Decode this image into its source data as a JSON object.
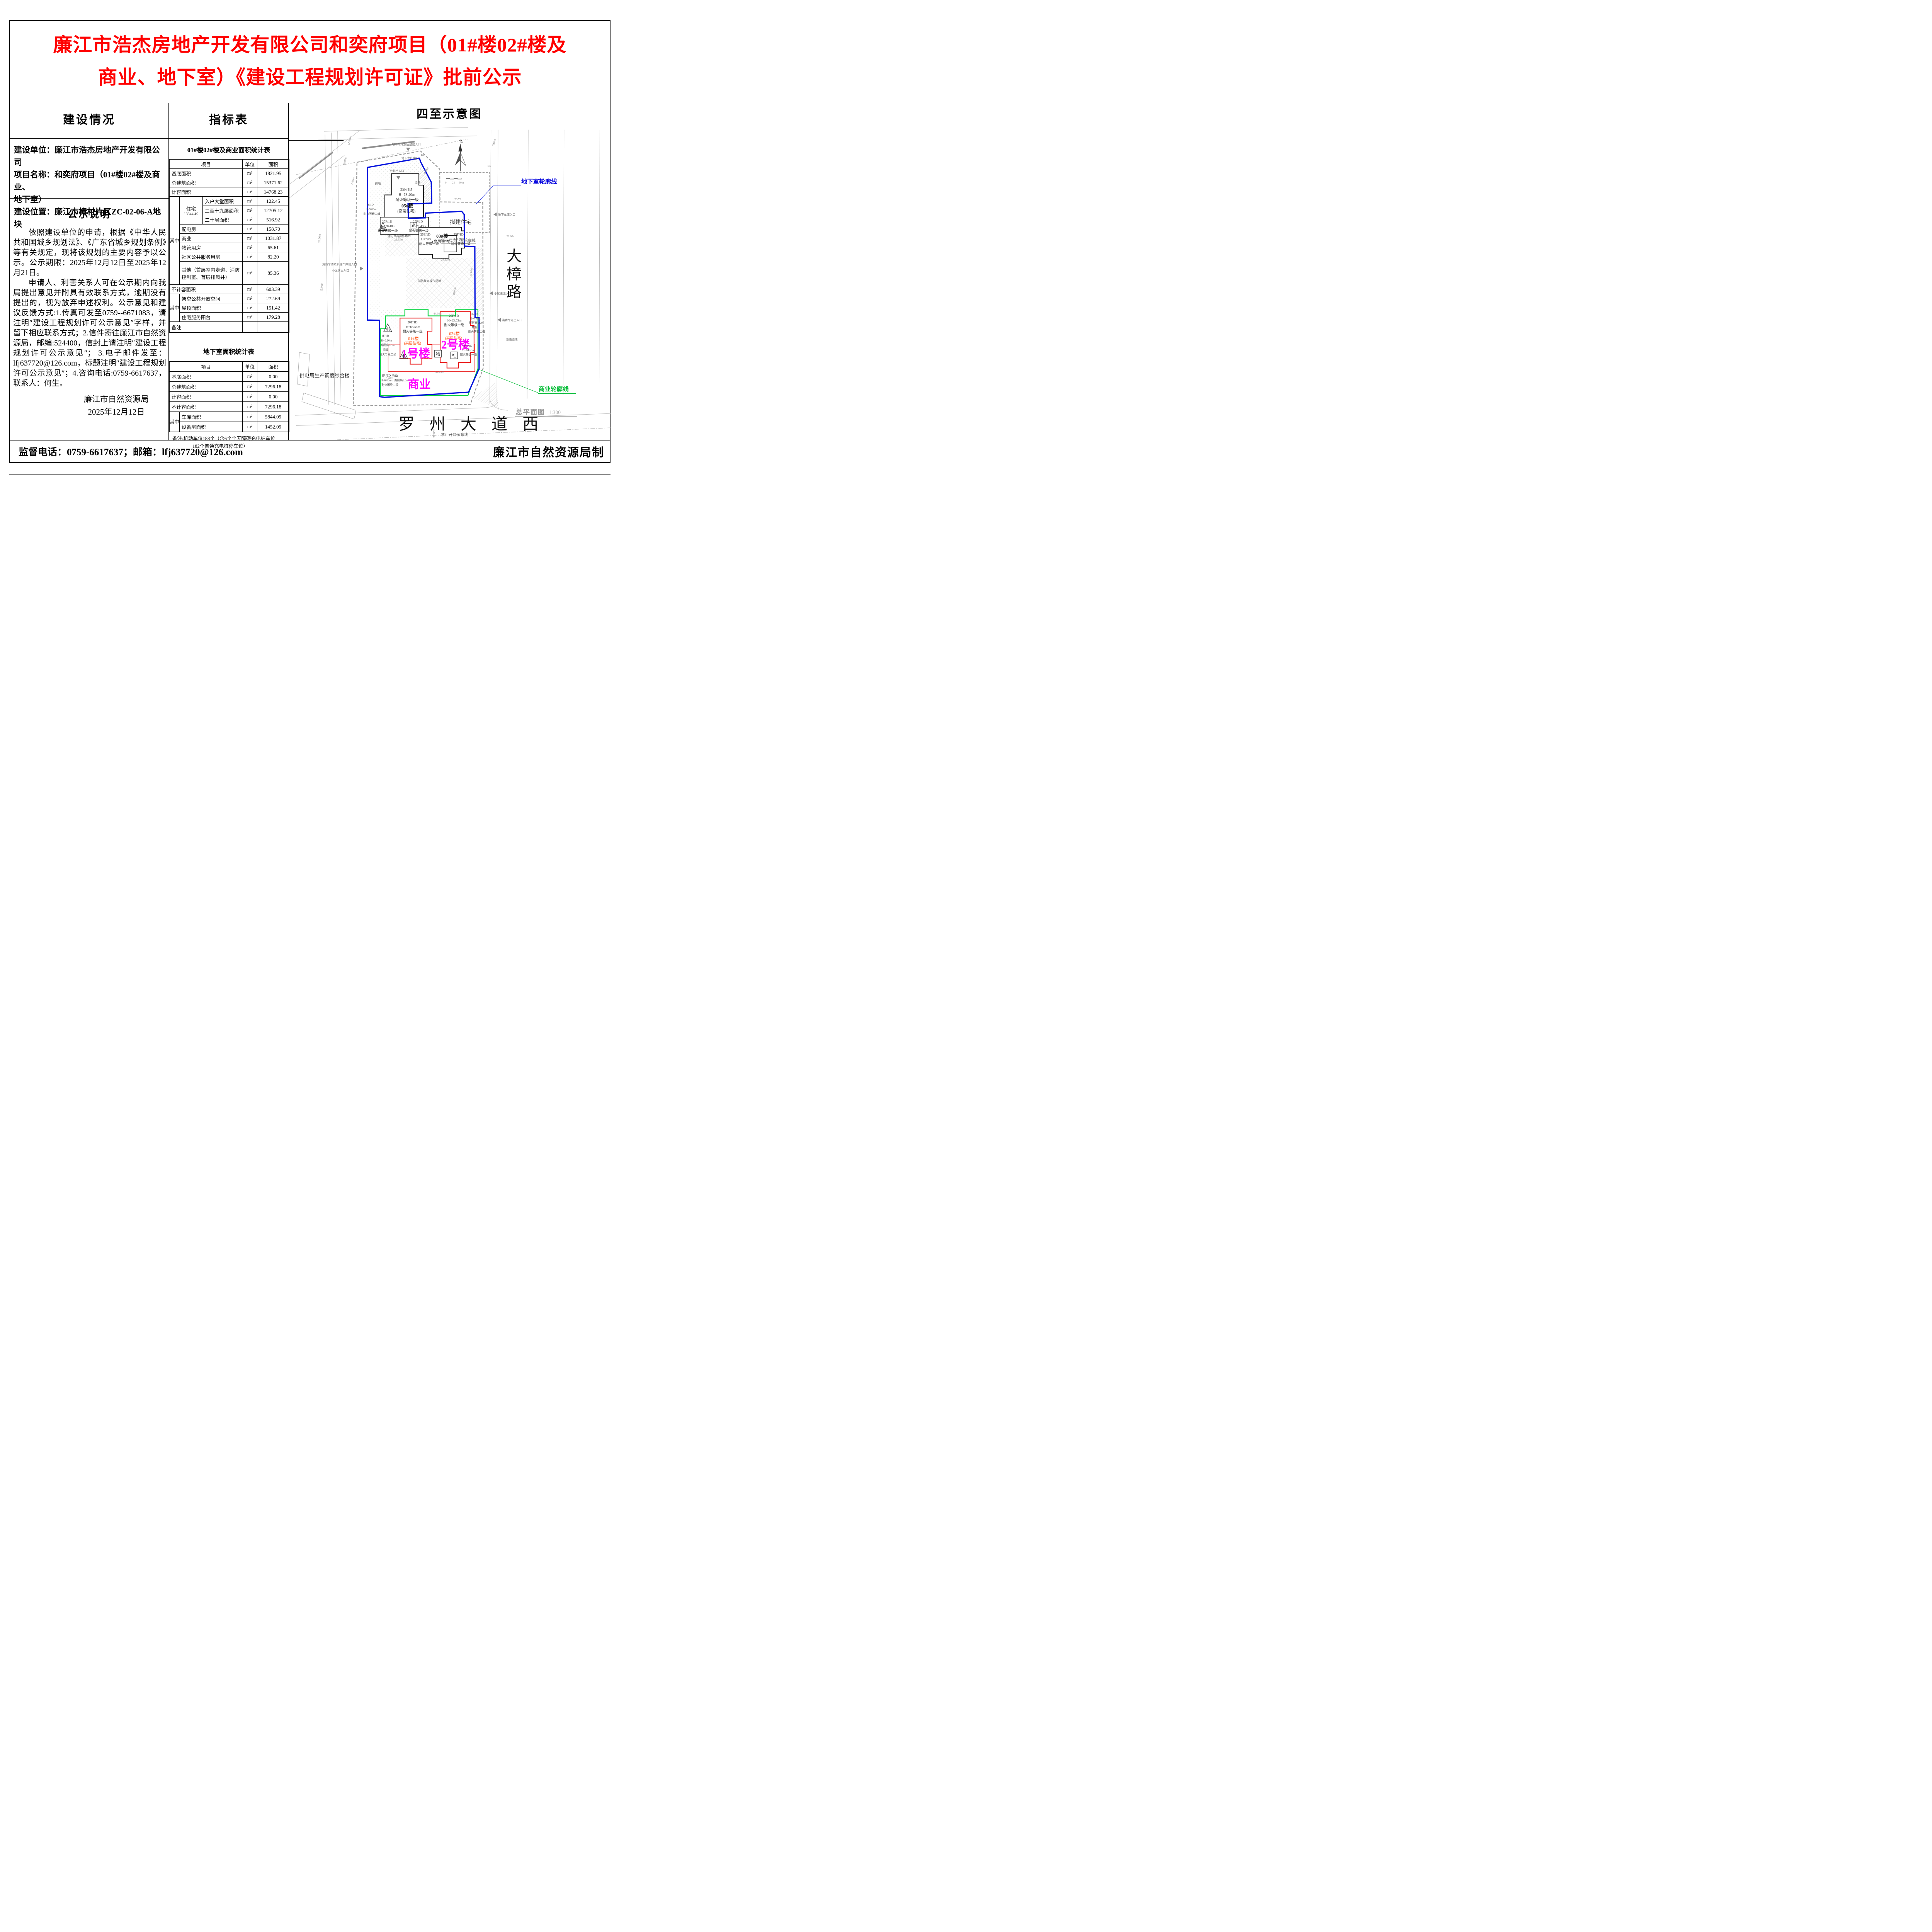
{
  "title": {
    "line1": "廉江市浩杰房地产开发有限公司和奕府项目（01#楼02#楼及",
    "line2": "商业、地下室）《建设工程规划许可证》批前公示"
  },
  "left": {
    "header": "建设情况",
    "info": [
      "建设单位：廉江市浩杰房地产开发有限公司",
      "项目名称：和奕府项目（01#楼02#楼及商业、",
      "地下室）",
      "建设位置：廉江市樟村片区ZC-02-06-A地块"
    ],
    "notice_header": "公示说明",
    "p1": "依照建设单位的申请，根据《中华人民共和国城乡规划法》、《广东省城乡规划条例》等有关规定，现将该规划的主要内容予以公示。公示期限：2025年12月12日至2025年12月21日。",
    "p2": "申请人、利害关系人可在公示期内向我局提出意见并附具有效联系方式，逾期没有提出的，视为放弃申述权利。公示意见和建议反馈方式:1.传真可发至0759--6671083，请注明″建设工程规划许可公示意见″字样，并留下相应联系方式；2.信件寄往廉江市自然资源局，邮编:524400，信封上请注明″建设工程规划许可公示意见″； 3.电子邮件发至：lfj637720@126.com，标题注明″建设工程规划许可公示意见″；4.咨询电话:0759-6617637，联系人：何生。",
    "sig_org": "廉江市自然资源局",
    "sig_date": "2025年12月12日"
  },
  "middle": {
    "header": "指标表",
    "table1": {
      "title": "01#楼02#楼及商业面积统计表",
      "h_item": "项目",
      "h_unit": "单位",
      "h_area": "面积",
      "r1": {
        "item": "基底面积",
        "unit": "m²",
        "area": "1821.95"
      },
      "r2": {
        "item": "总建筑面积",
        "unit": "m²",
        "area": "15371.62"
      },
      "r3": {
        "item": "计容面积",
        "unit": "m²",
        "area": "14768.23"
      },
      "qz1": "其中",
      "zz_label": "住宅",
      "zz_total": "13344.49",
      "z1": {
        "item": "入户大堂面积",
        "unit": "m²",
        "area": "122.45"
      },
      "z2": {
        "item": "二至十九层面积",
        "unit": "m²",
        "area": "12705.12"
      },
      "z3": {
        "item": "二十层面积",
        "unit": "m²",
        "area": "516.92"
      },
      "o1": {
        "item": "配电房",
        "unit": "m²",
        "area": "158.70"
      },
      "o2": {
        "item": "商业",
        "unit": "m²",
        "area": "1031.87"
      },
      "o3": {
        "item": "物管用房",
        "unit": "m²",
        "area": "65.61"
      },
      "o4": {
        "item": "社区公共服务用房",
        "unit": "m²",
        "area": "82.20"
      },
      "o5": {
        "item": "其他（首层室内走道、消防控制室、首层排风井）",
        "unit": "m²",
        "area": "85.36"
      },
      "r4": {
        "item": "不计容面积",
        "unit": "m²",
        "area": "603.39"
      },
      "qz2": "其中",
      "b1": {
        "item": "架空公共开放空间",
        "unit": "m²",
        "area": "272.69"
      },
      "b2": {
        "item": "屋顶面积",
        "unit": "m²",
        "area": "151.42"
      },
      "b3": {
        "item": "住宅服务阳台",
        "unit": "m²",
        "area": "179.28"
      },
      "remark": "备注"
    },
    "table2": {
      "title": "地下室面积统计表",
      "h_item": "项目",
      "h_unit": "单位",
      "h_area": "面积",
      "r1": {
        "item": "基底面积",
        "unit": "m²",
        "area": "0.00"
      },
      "r2": {
        "item": "总建筑面积",
        "unit": "m²",
        "area": "7296.18"
      },
      "r3": {
        "item": "计容面积",
        "unit": "m²",
        "area": "0.00"
      },
      "r4": {
        "item": "不计容面积",
        "unit": "m²",
        "area": "7296.18"
      },
      "qz": "其中",
      "q1": {
        "item": "车库面积",
        "unit": "m²",
        "area": "5844.09"
      },
      "q2": {
        "item": "设备房面积",
        "unit": "m²",
        "area": "1452.09"
      },
      "remark1": "备注:机动车位188个（含6个个无障碍充电桩车位",
      "remark2": "182个普通充电桩停车位）"
    }
  },
  "map": {
    "header": "四至示意图",
    "plan_label": "总平面图",
    "plan_scale": "1:300",
    "road_east": "大樟路",
    "road_south": "罗州大道西",
    "legend_basement": "地下室轮廓线",
    "legend_commercial": "商业轮廓线",
    "b1_outline": "负一层地下室轮廓线",
    "proposed": "拟建住宅",
    "power_bldg": "供电局生产调度综合楼",
    "north": "北",
    "scalebar": [
      "0",
      "25",
      "50m"
    ],
    "bldg": {
      "t05": "05#楼",
      "t03": "03#楼",
      "t01": "01#楼",
      "t02": "02#楼",
      "sub": "(高层住宅)",
      "spec25": "25F/1D",
      "h784": "H=78.40m",
      "h79": "H=79m",
      "fire1": "耐火等级一级",
      "spec20": "20F/1D",
      "h6355": "H=63.55m",
      "spec1f": "1F/1D",
      "h68": "H=6.80m",
      "h58": "H=5.80m",
      "first65": "首层高6.5m",
      "fire2": "耐火等级二级",
      "shop": "商业",
      "shop_row": "1F /1D 商业",
      "shop_row2": "H=6.80m，首层高6.5m"
    },
    "anno": {
      "no1": "1号楼",
      "no2": "2号楼",
      "shangye": "商业",
      "dian": "电",
      "wu": "物",
      "she": "社",
      "lao": "老",
      "entr_top": "地下车库及后勤出入口",
      "exit_top": "地下车库出口",
      "entr_back": "后勤出入口",
      "entr_garage": "地下车库入口",
      "entr_main": "小区主出入口",
      "exit_fire": "消防车道出入口",
      "entr_sw1": "消防车道及机械车库出入口",
      "entr_sw2": "小区次出入口",
      "no_open": "禁止开口示意线",
      "road_edge": "道路边线",
      "fire_pad": "消防登高操作场地",
      "green": "绿地",
      "r6": "R6",
      "lv": "·23.79"
    },
    "dims": [
      "12.00m",
      "19.06m",
      "2.00m",
      "22.00m",
      "15.00m",
      "23.85m",
      "28.32m",
      "44.56m",
      "52.15m",
      "5.40m",
      "20.00m",
      "35.00m",
      "4.00m",
      "17.00m",
      "10.00m",
      "5.00m"
    ]
  },
  "footer": {
    "left": "监督电话：0759-6617637；邮箱：lfj637720@126.com",
    "right": "廉江市自然资源局制"
  }
}
